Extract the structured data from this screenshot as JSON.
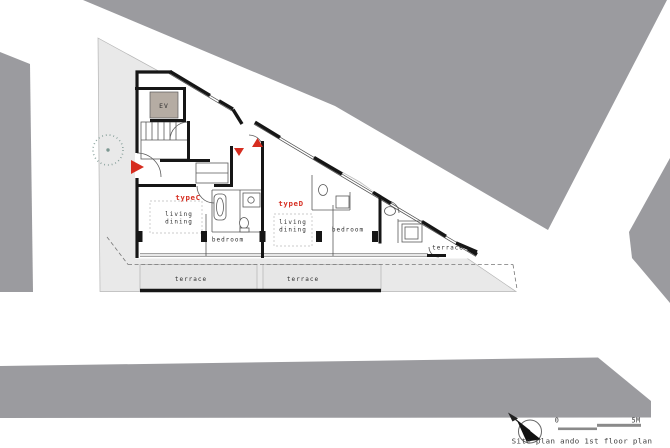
{
  "caption": "Site plan ando 1st floor plan",
  "scale_bar": {
    "zero": "0",
    "max": "5M"
  },
  "rooms": {
    "ev": "EV",
    "type_c": {
      "name": "typeC",
      "living": "living",
      "dining": "dining",
      "bedroom": "bedroom",
      "terrace": "terrace"
    },
    "type_d": {
      "name": "typeD",
      "living": "living",
      "dining": "dining",
      "bedroom": "bedroom",
      "terrace": "terrace"
    },
    "east_unit": {
      "terrace": "terrace"
    }
  },
  "colors": {
    "context_gray": "#9b9b9f",
    "site_gray": "#e9e9e9",
    "terrace_gray": "#e6e6e6",
    "wall_black": "#161616",
    "accent_red": "#d62d20",
    "ev_fill": "#b5aca3",
    "tree_green": "#7d9892",
    "scale_gray": "#8a8a8a"
  }
}
